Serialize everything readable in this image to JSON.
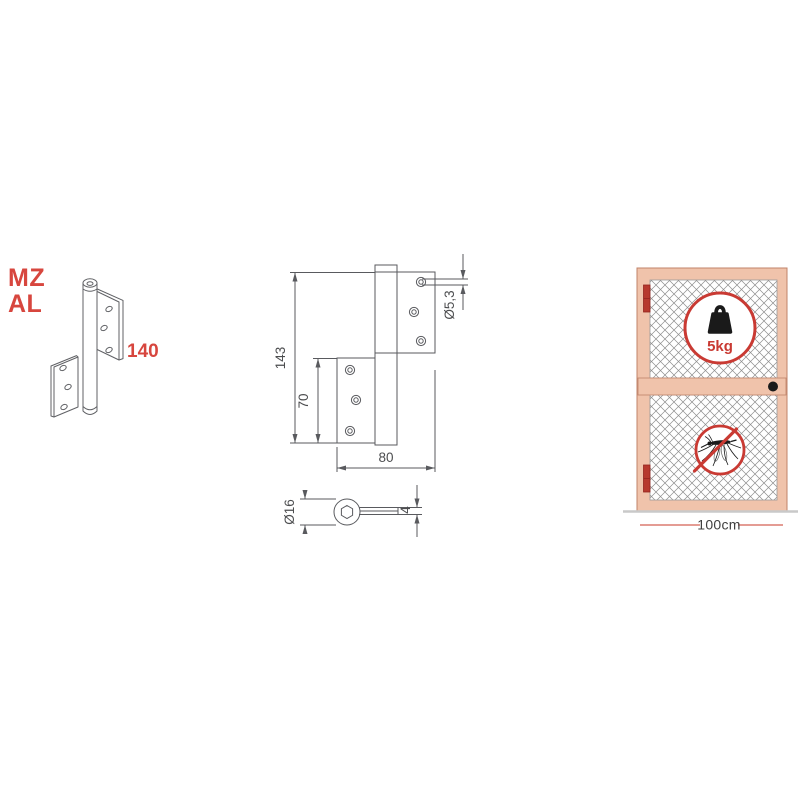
{
  "product": {
    "code_top": "MZ",
    "code_bottom": "AL",
    "length_mm": "140"
  },
  "technical_drawing": {
    "total_height_mm": "143",
    "leaf_height_mm": "70",
    "width_mm": "80",
    "screw_hole_diameter": "Ø5,3",
    "knuckle_diameter": "Ø16",
    "leaf_thickness_mm": "4"
  },
  "door_illustration": {
    "max_load": "5kg",
    "max_door_width": "100cm"
  },
  "icons": {
    "weight": "kettlebell-weight-icon",
    "mosquito": "mosquito-prohibited-icon"
  },
  "colors": {
    "accent_red": "#d7463e",
    "badge_red": "#c93a33",
    "drawing_line_gray": "#595a5e",
    "door_frame_fill": "#f0c3ab",
    "door_frame_border": "#c0836a",
    "door_hinge_red": "#b7392e",
    "mesh_gray": "#8d8d8d",
    "ground_gray": "#c9c9c9",
    "width_marker_red": "#dc7b70"
  }
}
